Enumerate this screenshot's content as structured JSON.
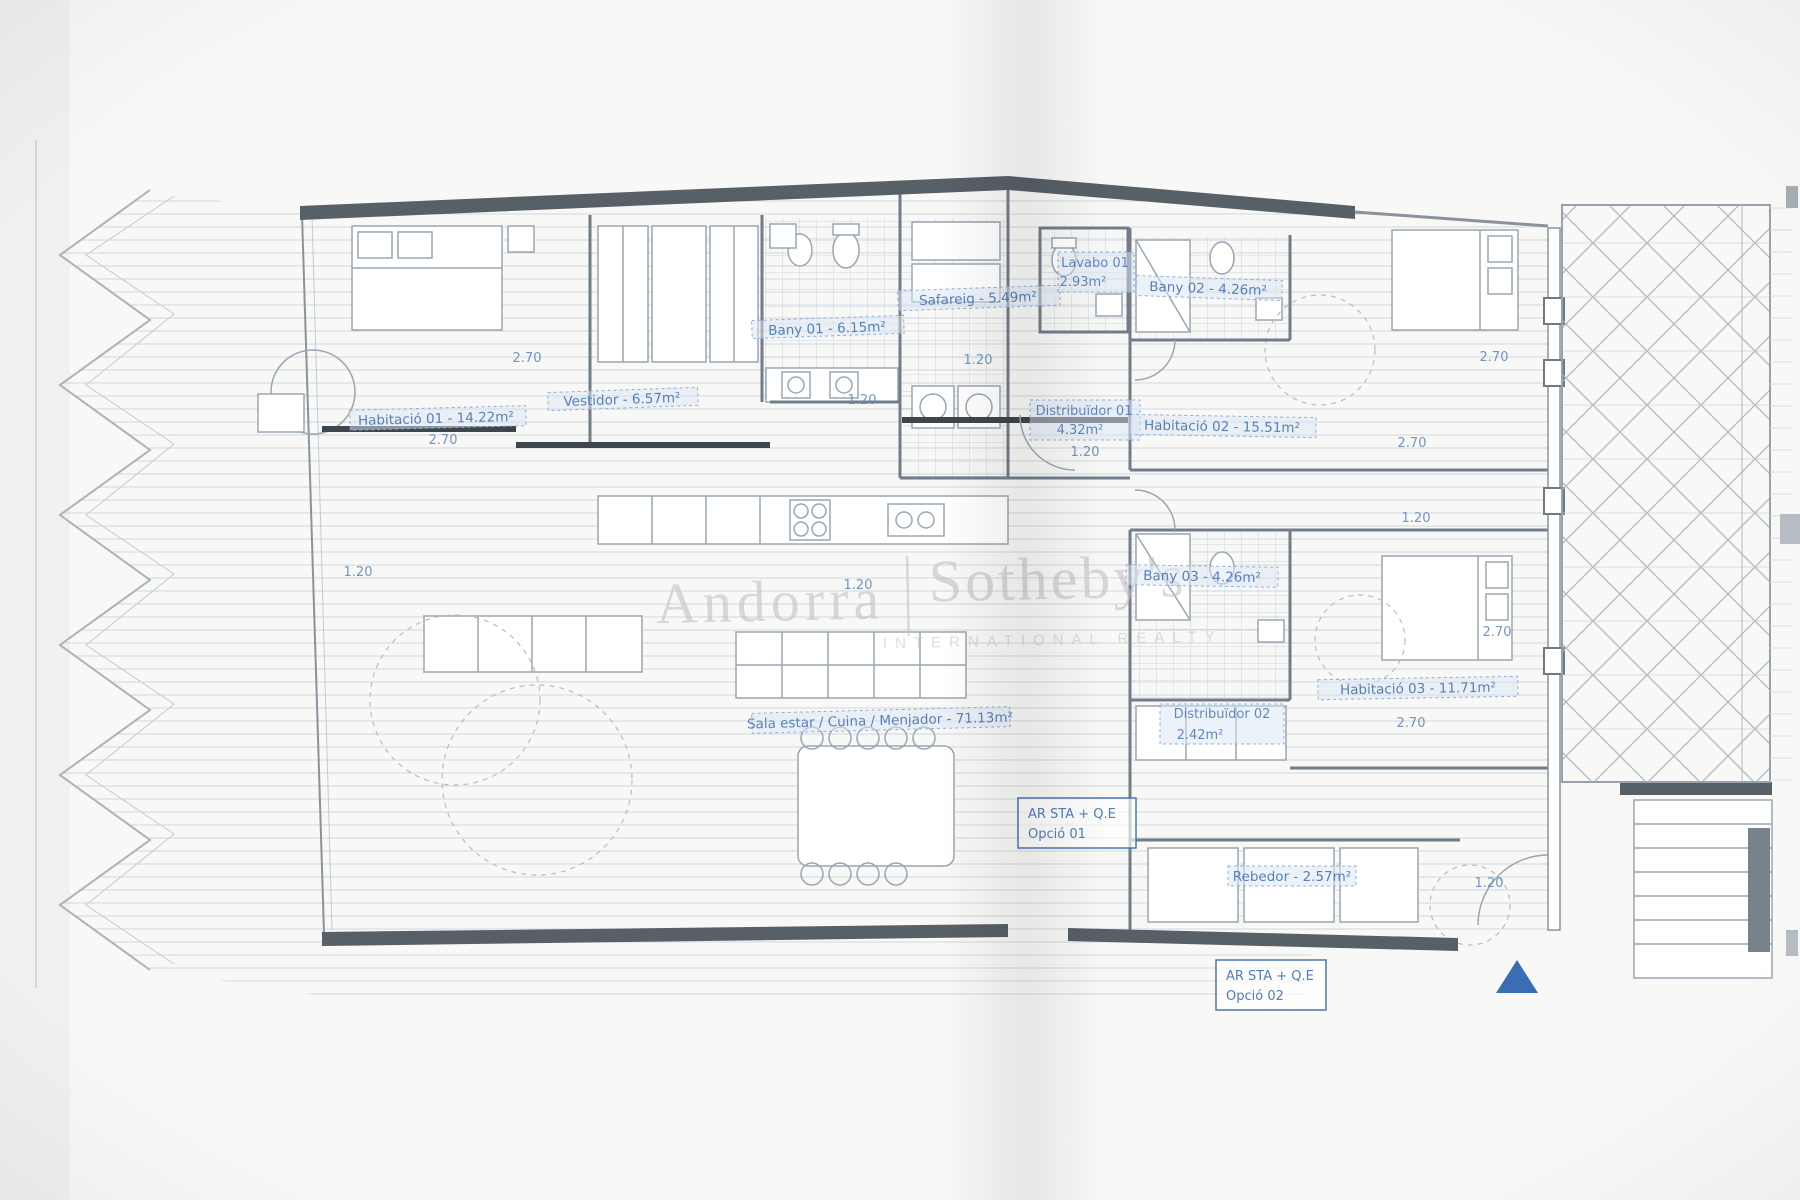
{
  "document": {
    "kind": "scanned floor plan",
    "language": "Catalan"
  },
  "palette": {
    "label_blue": "#4a77b4",
    "dim_blue": "#6188b8",
    "line_gray": "#9aa6b2",
    "wall_dark": "#3f454c",
    "band_dark": "#575f67",
    "watermark_gray": "#c2c2c2",
    "arrow_blue": "#3b6db4",
    "paper": "#f8f8f7"
  },
  "watermark": {
    "brand_left": "Andorra",
    "brand_right": "Sotheby's",
    "subtitle": "INTERNATIONAL REALTY"
  },
  "rooms": {
    "habitacio01": {
      "label": "Habitació 01 - 14.22m²"
    },
    "vestidor": {
      "label": "Vestidor - 6.57m²"
    },
    "bany01": {
      "label": "Bany 01 - 6.15m²"
    },
    "safareig": {
      "label": "Safareig - 5.49m²"
    },
    "lavabo01": {
      "line1": "Lavabo 01",
      "line2": "2.93m²"
    },
    "bany02": {
      "label": "Bany 02 - 4.26m²"
    },
    "distribuidor01": {
      "line1": "Distribuïdor 01",
      "line2": "4.32m²"
    },
    "habitacio02": {
      "label": "Habitació 02 - 15.51m²"
    },
    "bany03": {
      "label": "Bany 03 - 4.26m²"
    },
    "habitacio03": {
      "label": "Habitació 03 - 11.71m²"
    },
    "distribuidor02": {
      "line1": "Distribuïdor 02",
      "line2": "2.42m²"
    },
    "sala": {
      "label": "Sala estar / Cuina / Menjador - 71.13m²"
    },
    "rebedor": {
      "label": "Rebedor - 2.57m²"
    }
  },
  "options": {
    "opcio01": {
      "line1": "AR STA + Q.E",
      "line2": "Opció 01"
    },
    "opcio02": {
      "line1": "AR STA + Q.E",
      "line2": "Opció 02"
    }
  },
  "dims": [
    "2.70",
    "2.70",
    "1.20",
    "1.20",
    "1.20",
    "1.20",
    "1.20",
    "2.70",
    "2.70",
    "1.20",
    "2.70",
    "2.70",
    "1.20"
  ]
}
